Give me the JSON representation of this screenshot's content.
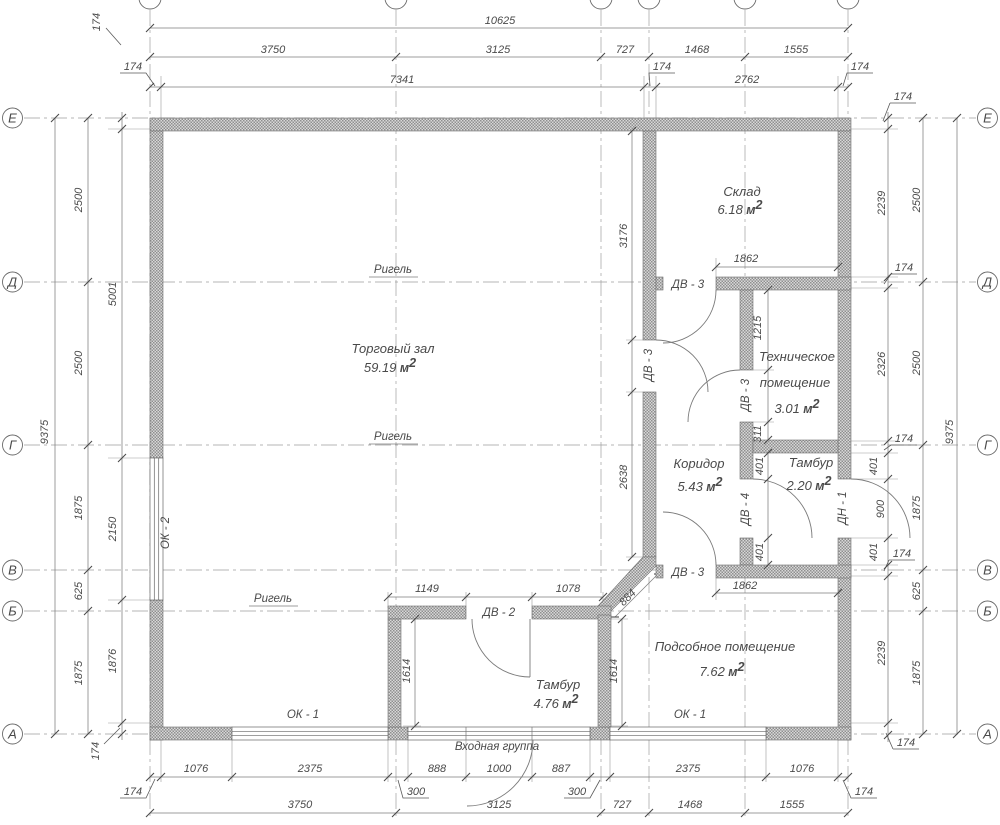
{
  "labels": {
    "entrance": "Входная группа"
  },
  "units": {
    "m": " м",
    "sup": "2"
  },
  "axes": {
    "row_letters": [
      "Е",
      "Д",
      "Г",
      "В",
      "Б",
      "А"
    ]
  },
  "rooms": [
    {
      "name_lines": [
        {
          "t": "Торговый зал",
          "x": 393,
          "y": 353
        }
      ],
      "area": "59.19",
      "ax": 390,
      "ay": 372
    },
    {
      "name_lines": [
        {
          "t": "Склад",
          "x": 742,
          "y": 196
        }
      ],
      "area": "6.18",
      "ax": 740,
      "ay": 214
    },
    {
      "name_lines": [
        {
          "t": "Техническое",
          "x": 797,
          "y": 361
        },
        {
          "t": "помещение",
          "x": 795,
          "y": 387
        }
      ],
      "area": "3.01",
      "ax": 797,
      "ay": 413
    },
    {
      "name_lines": [
        {
          "t": "Коридор",
          "x": 699,
          "y": 468
        }
      ],
      "area": "5.43",
      "ax": 700,
      "ay": 491
    },
    {
      "name_lines": [
        {
          "t": "Тамбур",
          "x": 811,
          "y": 467
        }
      ],
      "area": "2.20",
      "ax": 809,
      "ay": 490
    },
    {
      "name_lines": [
        {
          "t": "Подсобное помещение",
          "x": 725,
          "y": 651
        }
      ],
      "area": "7.62",
      "ax": 722,
      "ay": 676
    },
    {
      "name_lines": [
        {
          "t": "Тамбур",
          "x": 558,
          "y": 689
        }
      ],
      "area": "4.76",
      "ax": 556,
      "ay": 708
    }
  ],
  "rigel_labels": [
    {
      "t": "Ригель",
      "x": 393,
      "y": 273
    },
    {
      "t": "Ригель",
      "x": 393,
      "y": 440
    },
    {
      "t": "Ригель",
      "x": 273,
      "y": 602
    }
  ],
  "opening_labels": [
    {
      "t": "ДВ - 2",
      "x": 499,
      "y": 616
    },
    {
      "t": "ДВ - 3",
      "x": 688,
      "y": 288
    },
    {
      "t": "ДВ - 3",
      "x": 688,
      "y": 576
    },
    {
      "t": "ДВ - 3",
      "x": 652,
      "y": 365,
      "rot": -90
    },
    {
      "t": "ДВ - 3",
      "x": 749,
      "y": 395,
      "rot": -90
    },
    {
      "t": "ДВ - 4",
      "x": 749,
      "y": 509,
      "rot": -90
    },
    {
      "t": "ДН - 1",
      "x": 846,
      "y": 508,
      "rot": -90
    },
    {
      "t": "ОК - 2",
      "x": 169,
      "y": 533,
      "rot": -90
    },
    {
      "t": "ОК - 1",
      "x": 303,
      "y": 718
    },
    {
      "t": "ОК - 1",
      "x": 690,
      "y": 718
    }
  ],
  "dim_labels": [
    {
      "t": "10625",
      "x": 500,
      "y": 24
    },
    {
      "t": "3750",
      "x": 273,
      "y": 53
    },
    {
      "t": "3125",
      "x": 498,
      "y": 53
    },
    {
      "t": "727",
      "x": 625,
      "y": 53
    },
    {
      "t": "1468",
      "x": 697,
      "y": 53
    },
    {
      "t": "1555",
      "x": 796,
      "y": 53
    },
    {
      "t": "174",
      "x": 133,
      "y": 70
    },
    {
      "t": "7341",
      "x": 402,
      "y": 83
    },
    {
      "t": "174",
      "x": 662,
      "y": 70
    },
    {
      "t": "2762",
      "x": 747,
      "y": 83
    },
    {
      "t": "174",
      "x": 860,
      "y": 70
    },
    {
      "t": "1076",
      "x": 196,
      "y": 772
    },
    {
      "t": "2375",
      "x": 310,
      "y": 772
    },
    {
      "t": "888",
      "x": 437,
      "y": 772
    },
    {
      "t": "1000",
      "x": 499,
      "y": 772
    },
    {
      "t": "887",
      "x": 561,
      "y": 772
    },
    {
      "t": "2375",
      "x": 688,
      "y": 772
    },
    {
      "t": "1076",
      "x": 802,
      "y": 772
    },
    {
      "t": "174",
      "x": 133,
      "y": 795
    },
    {
      "t": "300",
      "x": 416,
      "y": 795
    },
    {
      "t": "300",
      "x": 577,
      "y": 795
    },
    {
      "t": "174",
      "x": 864,
      "y": 795
    },
    {
      "t": "3750",
      "x": 300,
      "y": 808
    },
    {
      "t": "3125",
      "x": 499,
      "y": 808
    },
    {
      "t": "727",
      "x": 622,
      "y": 808
    },
    {
      "t": "1468",
      "x": 690,
      "y": 808
    },
    {
      "t": "1555",
      "x": 792,
      "y": 808
    },
    {
      "t": "9375",
      "x": 48,
      "y": 432,
      "rot": -90
    },
    {
      "t": "2500",
      "x": 82,
      "y": 200,
      "rot": -90
    },
    {
      "t": "2500",
      "x": 82,
      "y": 363,
      "rot": -90
    },
    {
      "t": "1875",
      "x": 82,
      "y": 508,
      "rot": -90
    },
    {
      "t": "625",
      "x": 82,
      "y": 591,
      "rot": -90
    },
    {
      "t": "1875",
      "x": 82,
      "y": 673,
      "rot": -90
    },
    {
      "t": "174",
      "x": 100,
      "y": 22,
      "rot": -90
    },
    {
      "t": "5001",
      "x": 116,
      "y": 294,
      "rot": -90
    },
    {
      "t": "2150",
      "x": 116,
      "y": 529,
      "rot": -90
    },
    {
      "t": "1876",
      "x": 116,
      "y": 661,
      "rot": -90
    },
    {
      "t": "174",
      "x": 99,
      "y": 751,
      "rot": -90
    },
    {
      "t": "174",
      "x": 903,
      "y": 100
    },
    {
      "t": "2239",
      "x": 885,
      "y": 203,
      "rot": -90
    },
    {
      "t": "174",
      "x": 904,
      "y": 271
    },
    {
      "t": "2326",
      "x": 885,
      "y": 364,
      "rot": -90
    },
    {
      "t": "174",
      "x": 904,
      "y": 442
    },
    {
      "t": "401",
      "x": 877,
      "y": 466,
      "rot": -90
    },
    {
      "t": "900",
      "x": 884,
      "y": 509,
      "rot": -90
    },
    {
      "t": "401",
      "x": 877,
      "y": 552,
      "rot": -90
    },
    {
      "t": "174",
      "x": 902,
      "y": 557
    },
    {
      "t": "2239",
      "x": 885,
      "y": 653,
      "rot": -90
    },
    {
      "t": "174",
      "x": 906,
      "y": 746
    },
    {
      "t": "2500",
      "x": 920,
      "y": 200,
      "rot": -90
    },
    {
      "t": "2500",
      "x": 920,
      "y": 363,
      "rot": -90
    },
    {
      "t": "1875",
      "x": 920,
      "y": 508,
      "rot": -90
    },
    {
      "t": "625",
      "x": 920,
      "y": 591,
      "rot": -90
    },
    {
      "t": "1875",
      "x": 920,
      "y": 673,
      "rot": -90
    },
    {
      "t": "9375",
      "x": 953,
      "y": 432,
      "rot": -90
    },
    {
      "t": "3176",
      "x": 627,
      "y": 236,
      "rot": -90
    },
    {
      "t": "2638",
      "x": 627,
      "y": 477,
      "rot": -90
    },
    {
      "t": "1862",
      "x": 746,
      "y": 262
    },
    {
      "t": "1862",
      "x": 745,
      "y": 589
    },
    {
      "t": "1215",
      "x": 761,
      "y": 328,
      "rot": -90
    },
    {
      "t": "311",
      "x": 761,
      "y": 434,
      "rot": -90
    },
    {
      "t": "401",
      "x": 763,
      "y": 466,
      "rot": -90
    },
    {
      "t": "401",
      "x": 763,
      "y": 552,
      "rot": -90
    },
    {
      "t": "1149",
      "x": 427,
      "y": 592
    },
    {
      "t": "1078",
      "x": 568,
      "y": 592
    },
    {
      "t": "884",
      "x": 630,
      "y": 600,
      "rot": -45
    },
    {
      "t": "1614",
      "x": 410,
      "y": 671,
      "rot": -90
    },
    {
      "t": "1614",
      "x": 617,
      "y": 671,
      "rot": -90
    }
  ]
}
